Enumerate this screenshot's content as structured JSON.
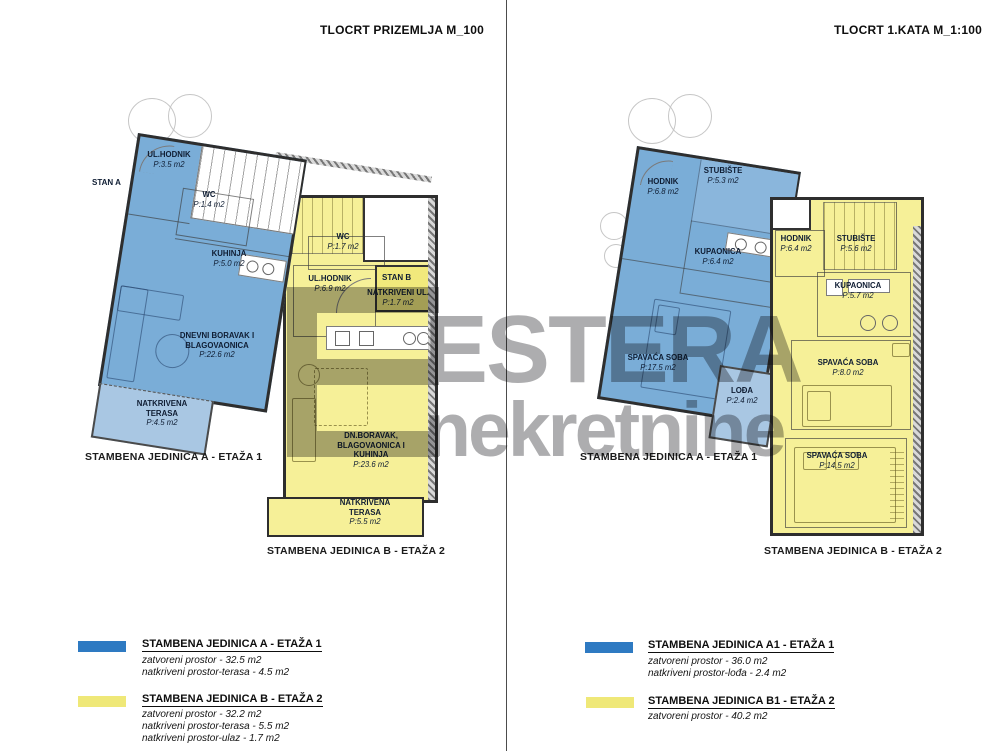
{
  "page": {
    "left_title": "TLOCRT PRIZEMLJA  M_100",
    "right_title": "TLOCRT 1.KATA  M_1:100"
  },
  "watermark": {
    "brand": "ESTERA",
    "brand_sub": "nekretnine"
  },
  "colors": {
    "unit_a_fill": "#7aadd7",
    "unit_b_fill": "#f6f098",
    "unit_a_swatch": "#2e7ac2",
    "unit_b_swatch": "#efe878",
    "terrace_fill": "#a9c7e3",
    "watermark_gray": "#9b9b9d"
  },
  "left_plan": {
    "stan_a_label": "STAN A",
    "stan_b_label": "STAN B",
    "caption_a": "STAMBENA JEDINICA A - ETAŽA 1",
    "caption_b": "STAMBENA JEDINICA B - ETAŽA 2",
    "rooms_a": [
      {
        "name": "UL.HODNIK",
        "area": "P:3.5 m2"
      },
      {
        "name": "WC",
        "area": "P:1.4 m2"
      },
      {
        "name": "KUHINJA",
        "area": "P:5.0 m2"
      },
      {
        "name": "DNEVNI BORAVAK I BLAGOVAONICA",
        "area": "P:22.6 m2"
      },
      {
        "name": "NATKRIVENA TERASA",
        "area": "P:4.5 m2"
      }
    ],
    "rooms_b": [
      {
        "name": "WC",
        "area": "P:1.7 m2"
      },
      {
        "name": "UL.HODNIK",
        "area": "P:6.9 m2"
      },
      {
        "name": "NATKRIVENI UL.",
        "area": "P:1.7 m2"
      },
      {
        "name": "DN.BORAVAK, BLAGOVAONICA I KUHINJA",
        "area": "P:23.6 m2"
      },
      {
        "name": "NATKRIVENA TERASA",
        "area": "P:5.5 m2"
      }
    ]
  },
  "right_plan": {
    "caption_a": "STAMBENA JEDINICA A - ETAŽA 1",
    "caption_b": "STAMBENA JEDINICA B - ETAŽA 2",
    "rooms_a": [
      {
        "name": "HODNIK",
        "area": "P:6.8 m2"
      },
      {
        "name": "STUBIŠTE",
        "area": "P:5.3 m2"
      },
      {
        "name": "KUPAONICA",
        "area": "P:6.4 m2"
      },
      {
        "name": "SPAVAĆA SOBA",
        "area": "P:17.5 m2"
      },
      {
        "name": "LOĐA",
        "area": "P:2.4 m2"
      }
    ],
    "rooms_b": [
      {
        "name": "HODNIK",
        "area": "P:6.4 m2"
      },
      {
        "name": "STUBIŠTE",
        "area": "P:5.6 m2"
      },
      {
        "name": "KUPAONICA",
        "area": "P:5.7 m2"
      },
      {
        "name": "SPAVAĆA SOBA",
        "area": "P:8.0 m2"
      },
      {
        "name": "SPAVAĆA SOBA",
        "area": "P:14.5 m2"
      }
    ]
  },
  "legend_left": {
    "groups": [
      {
        "title": "STAMBENA JEDINICA A - ETAŽA 1",
        "lines": [
          "zatvoreni prostor - 32.5 m2",
          "natkriveni prostor-terasa - 4.5 m2"
        ]
      },
      {
        "title": "STAMBENA JEDINICA B - ETAŽA 2",
        "lines": [
          "zatvoreni prostor - 32.2 m2",
          "natkriveni prostor-terasa - 5.5 m2",
          "natkriveni prostor-ulaz - 1.7 m2"
        ]
      }
    ]
  },
  "legend_right": {
    "groups": [
      {
        "title": "STAMBENA JEDINICA A1 - ETAŽA 1",
        "lines": [
          "zatvoreni prostor - 36.0 m2",
          "natkriveni prostor-lođa - 2.4 m2"
        ]
      },
      {
        "title": "STAMBENA JEDINICA B1 - ETAŽA 2",
        "lines": [
          "zatvoreni prostor - 40.2 m2"
        ]
      }
    ]
  }
}
